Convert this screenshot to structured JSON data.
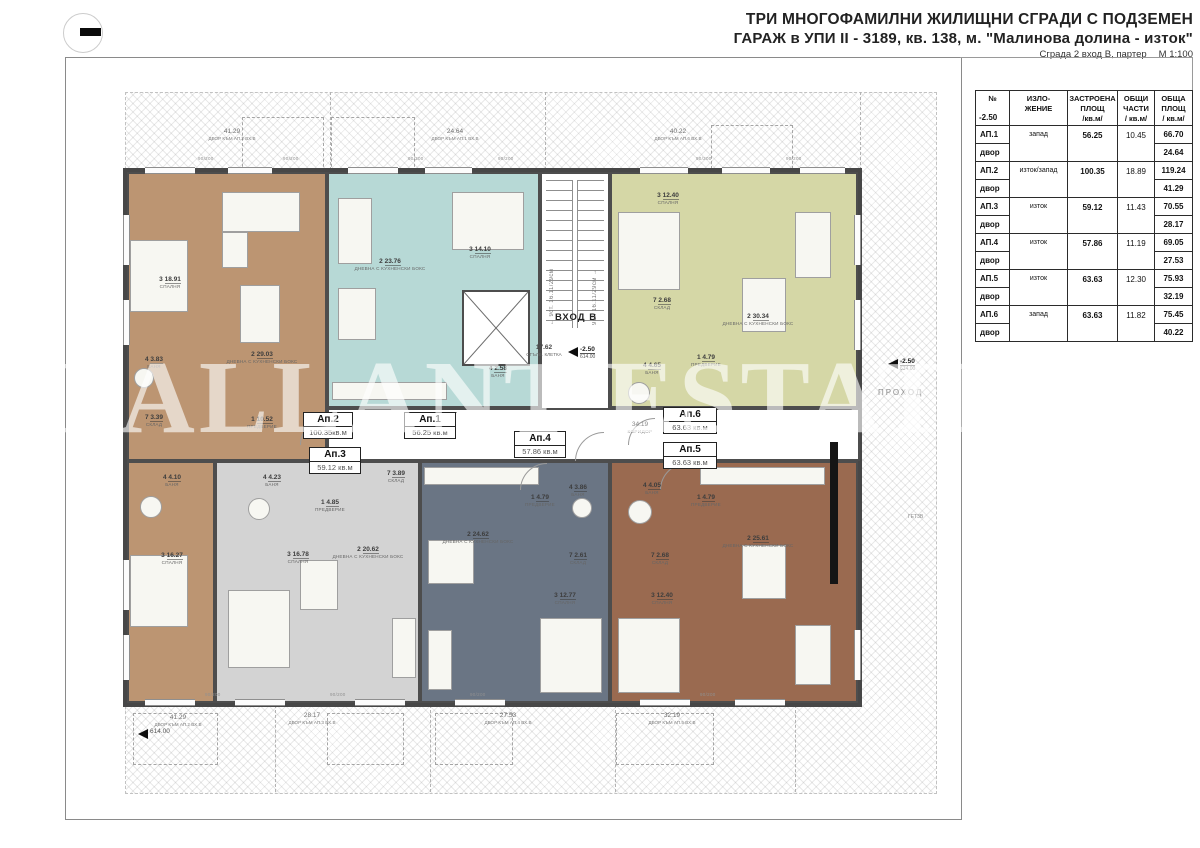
{
  "title": {
    "line1": "ТРИ МНОГОФАМИЛНИ ЖИЛИЩНИ СГРАДИ С ПОДЗЕМЕН",
    "line2": "ГАРАЖ в УПИ II - 3189, кв. 138, м. \"Малинова долина - изток\"",
    "line3": "Сграда 2 вход В, партер",
    "scale": "М 1:100"
  },
  "watermark": "PALLANT ESTATE",
  "table": {
    "head_num": "№",
    "head_level": "-2.50",
    "head_orient": "ИЗЛО-\nЖЕНИЕ",
    "head_built": "ЗАСТРОЕНА\nПЛОЩ\n/кв.м/",
    "head_common": "ОБЩИ\nЧАСТИ\n/ кв.м/",
    "head_total": "ОБЩА\nПЛОЩ\n/ кв.м/",
    "rows": [
      {
        "id": "АП.1",
        "orientation": "запад",
        "built": "56.25",
        "common": "10.45",
        "total": "66.70",
        "yard_label": "двор",
        "yard": "24.64"
      },
      {
        "id": "АП.2",
        "orientation": "изток/запад",
        "built": "100.35",
        "common": "18.89",
        "total": "119.24",
        "yard_label": "двор",
        "yard": "41.29"
      },
      {
        "id": "АП.3",
        "orientation": "изток",
        "built": "59.12",
        "common": "11.43",
        "total": "70.55",
        "yard_label": "двор",
        "yard": "28.17"
      },
      {
        "id": "АП.4",
        "orientation": "изток",
        "built": "57.86",
        "common": "11.19",
        "total": "69.05",
        "yard_label": "двор",
        "yard": "27.53"
      },
      {
        "id": "АП.5",
        "orientation": "изток",
        "built": "63.63",
        "common": "12.30",
        "total": "75.93",
        "yard_label": "двор",
        "yard": "32.19"
      },
      {
        "id": "АП.6",
        "orientation": "запад",
        "built": "63.63",
        "common": "11.82",
        "total": "75.45",
        "yard_label": "двор",
        "yard": "40.22"
      }
    ]
  },
  "plan": {
    "entrance_label": "ВХОД В",
    "stairwell": {
      "area": "17.62",
      "name": "СТЪЛБ. КЛЕТКА",
      "level": "-2.50",
      "elevation": "614.00"
    },
    "stair_flight_left": "← 9ст. 16.11/29см",
    "stair_flight_right": "9ст. 16.11/29см →",
    "corridor": {
      "area": "34.19",
      "name": "КОРИДОР"
    },
    "passage": {
      "name": "ПРОХОД",
      "level": "-2.50",
      "elevation": "614.00"
    },
    "side_note": "ГЕТ3В",
    "ground_marker": "614.00",
    "opening_mark": "90/200",
    "apartments": [
      {
        "tag": "Ап.2",
        "area": "100.35",
        "unit": "кв.м",
        "rooms": [
          {
            "num": "3",
            "area": "18.91",
            "name": "СПАЛНЯ"
          },
          {
            "num": "2",
            "area": "29.03",
            "name": "ДНЕВНА С КУХНЕНСКИ БОКС"
          },
          {
            "num": "4",
            "area": "3.83",
            "name": "БАНЯ"
          },
          {
            "num": "7",
            "area": "3.39",
            "name": "СКЛАД"
          },
          {
            "num": "1",
            "area": "10.52",
            "name": "ПРЕДВЕРИЕ"
          },
          {
            "num": "4",
            "area": "4.10",
            "name": "БАНЯ"
          },
          {
            "num": "3",
            "area": "16.27",
            "name": "СПАЛНЯ"
          }
        ]
      },
      {
        "tag": "Ап.1",
        "area": "56.25",
        "unit": "кв.м",
        "rooms": [
          {
            "num": "2",
            "area": "23.76",
            "name": "ДНЕВНА С КУХНЕНСКИ БОКС"
          },
          {
            "num": "3",
            "area": "14.10",
            "name": "СПАЛНЯ"
          },
          {
            "num": "4",
            "area": "2.58",
            "name": "БАНЯ"
          }
        ]
      },
      {
        "tag": "Ап.6",
        "area": "63.63",
        "unit": "кв.м",
        "rooms": [
          {
            "num": "3",
            "area": "12.40",
            "name": "СПАЛНЯ"
          },
          {
            "num": "7",
            "area": "2.68",
            "name": "СКЛАД"
          },
          {
            "num": "2",
            "area": "30.34",
            "name": "ДНЕВНА С КУХНЕНСКИ БОКС"
          },
          {
            "num": "4",
            "area": "4.65",
            "name": "БАНЯ"
          },
          {
            "num": "1",
            "area": "4.79",
            "name": "ПРЕДВЕРИЕ"
          }
        ]
      },
      {
        "tag": "Ап.3",
        "area": "59.12",
        "unit": "кв.м",
        "rooms": [
          {
            "num": "4",
            "area": "4.23",
            "name": "БАНЯ"
          },
          {
            "num": "1",
            "area": "4.85",
            "name": "ПРЕДВЕРИЕ"
          },
          {
            "num": "7",
            "area": "3.89",
            "name": "СКЛАД"
          },
          {
            "num": "3",
            "area": "16.78",
            "name": "СПАЛНЯ"
          },
          {
            "num": "2",
            "area": "20.62",
            "name": "ДНЕВНА С КУХНЕНСКИ БОКС"
          }
        ]
      },
      {
        "tag": "Ап.4",
        "area": "57.86",
        "unit": "кв.м",
        "rooms": [
          {
            "num": "1",
            "area": "4.79",
            "name": "ПРЕДВЕРИЕ"
          },
          {
            "num": "4",
            "area": "3.86",
            "name": "БАНЯ"
          },
          {
            "num": "2",
            "area": "24.62",
            "name": "ДНЕВНА С КУХНЕНСКИ БОКС"
          },
          {
            "num": "7",
            "area": "2.61",
            "name": "СКЛАД"
          },
          {
            "num": "3",
            "area": "12.77",
            "name": "СПАЛНЯ"
          }
        ]
      },
      {
        "tag": "Ап.5",
        "area": "63.63",
        "unit": "кв.м",
        "rooms": [
          {
            "num": "4",
            "area": "4.05",
            "name": "БАНЯ"
          },
          {
            "num": "1",
            "area": "4.79",
            "name": "ПРЕДВЕРИЕ"
          },
          {
            "num": "7",
            "area": "2.68",
            "name": "СКЛАД"
          },
          {
            "num": "3",
            "area": "12.40",
            "name": "СПАЛНЯ"
          },
          {
            "num": "2",
            "area": "25.61",
            "name": "ДНЕВНА С КУХНЕНСКИ БОКС"
          }
        ]
      }
    ],
    "yards_top": [
      {
        "area": "41.29",
        "name": "ДВОР КЪМ АП.2 ВХ.В"
      },
      {
        "area": "24.64",
        "name": "ДВОР КЪМ АП.1 ВХ.В"
      },
      {
        "area": "40.22",
        "name": "ДВОР КЪМ АП.6 ВХ.В"
      }
    ],
    "yards_bottom": [
      {
        "area": "41.29",
        "name": "ДВОР КЪМ АП.2 ВХ.В"
      },
      {
        "area": "28.17",
        "name": "ДВОР КЪМ АП.3 ВХ.В"
      },
      {
        "area": "27.53",
        "name": "ДВОР КЪМ АП.4 ВХ.В"
      },
      {
        "area": "32.19",
        "name": "ДВОР КЪМ АП.5 ВХ.В"
      }
    ]
  },
  "colors": {
    "ap1_teal": "#b7d9d6",
    "ap2_tan": "#bc9572",
    "ap3_gray": "#d3d3d3",
    "ap4_slate": "#6a7584",
    "ap5_brown": "#9a6a50",
    "ap6_olive": "#d5d7a6",
    "wall": "#4d4d4d"
  }
}
